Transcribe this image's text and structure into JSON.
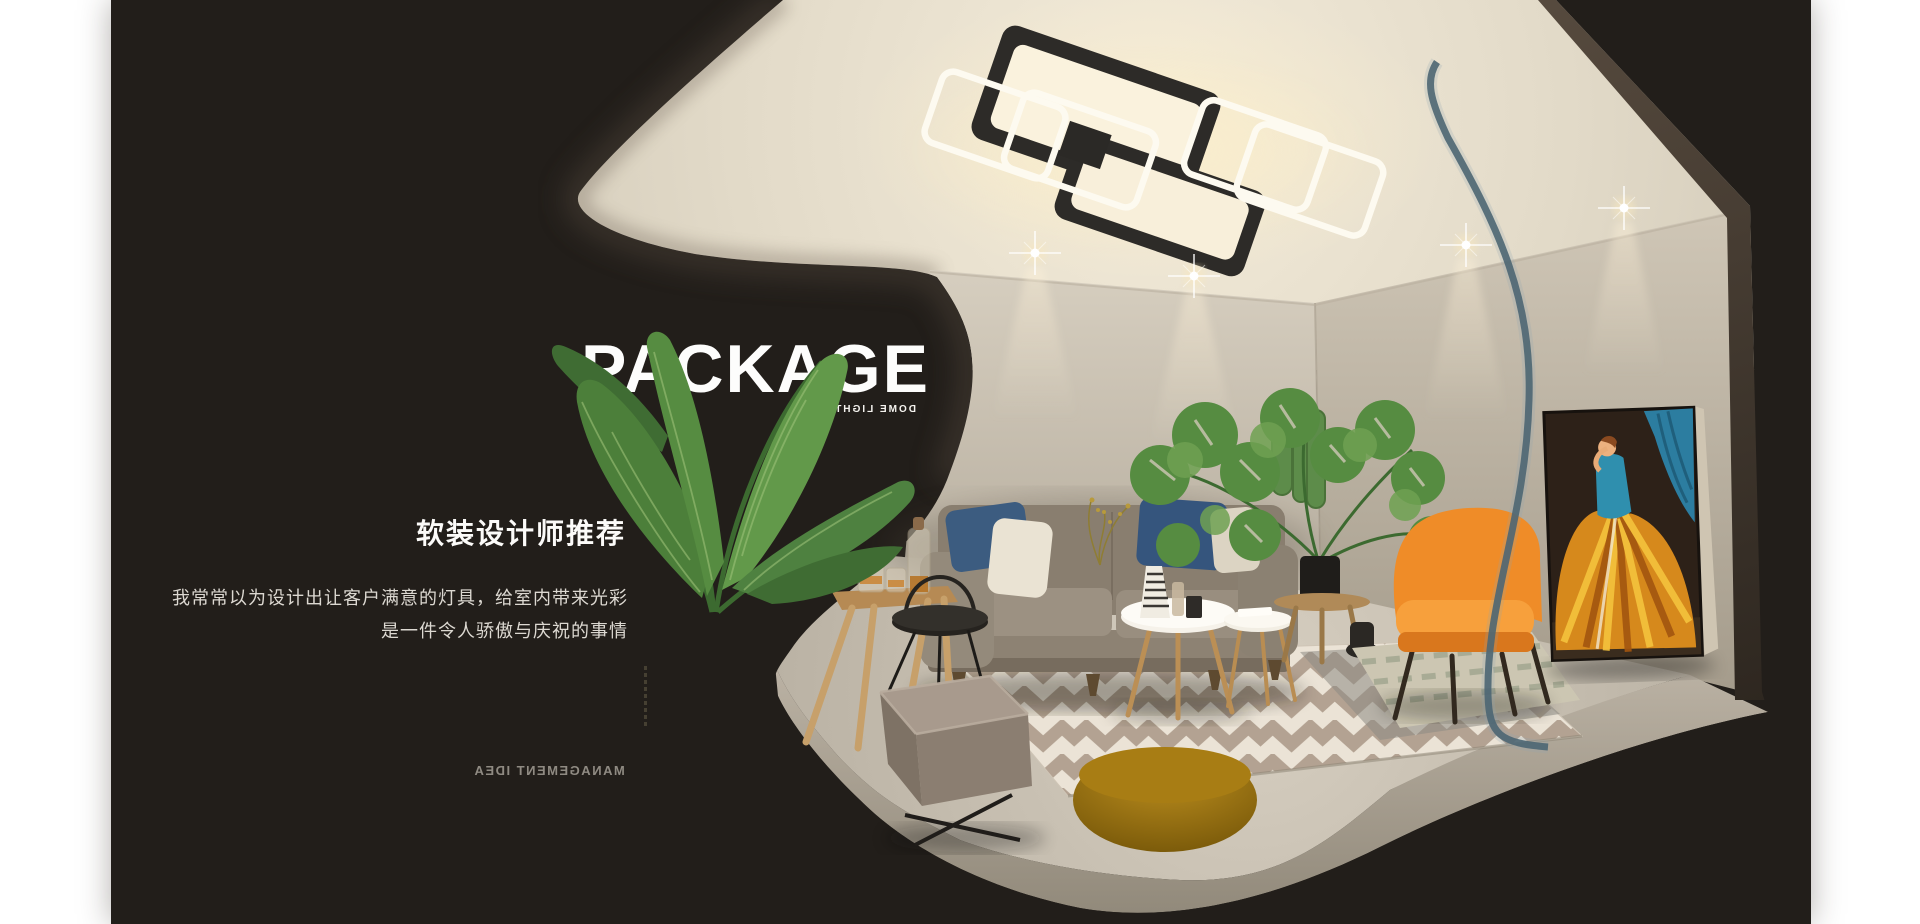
{
  "banner": {
    "title": "PACKAGE",
    "title_caption_mirrored": "DOME LIGHT",
    "heading": "软装设计师推荐",
    "paragraph": [
      "我常常以为设计出让客户满意的灯具，给室内带来光彩",
      "是一件令人骄傲与庆祝的事情"
    ],
    "footer_caption_mirrored": "MANAGEMENT IDEA"
  },
  "colors": {
    "page_margin": "#ffffff",
    "canvas": "#221e1a",
    "ceiling": "#ece4d2",
    "wall": "#c6bdae",
    "floor": "#ccc4b6",
    "accent_orange": "#ef8c28",
    "glass_teal": "#4c6673",
    "rug_cream": "#ebe3d6",
    "rug_taupe": "#b3a292",
    "pillow_navy": "#3a5a7e",
    "plant_green": "#568c41",
    "painting_gown": "#d6891c",
    "lamp_glow": "#f8f0dc"
  },
  "scene": {
    "objects": "ceiling-lamp, downlights, sofa, pillows, coffee-tables, area-rug, square-pouf, round-ottoman, side-table, tray-table, orange-armchair, monstera-plant, cactus, banana-plant, wall-art-painting, glass-partition"
  }
}
